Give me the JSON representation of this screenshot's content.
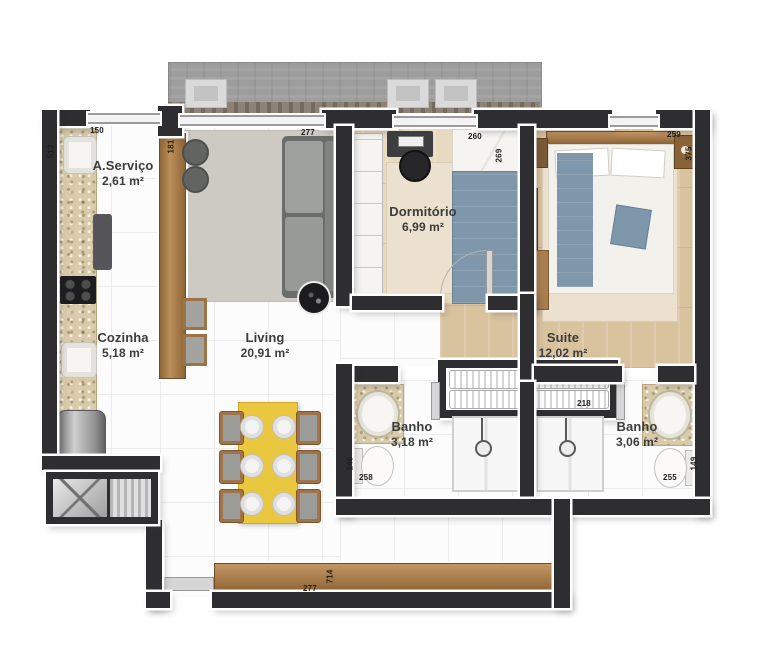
{
  "rooms": {
    "servico": {
      "name": "A.Serviço",
      "area": "2,61 m²"
    },
    "cozinha": {
      "name": "Cozinha",
      "area": "5,18 m²"
    },
    "living": {
      "name": "Living",
      "area": "20,91 m²"
    },
    "dormitorio": {
      "name": "Dormitório",
      "area": "6,99 m²"
    },
    "suite": {
      "name": "Suite",
      "area": "12,02 m²"
    },
    "banho_social": {
      "name": "Banho",
      "area": "3,18 m²"
    },
    "banho_suite": {
      "name": "Banho",
      "area": "3,06 m²"
    }
  },
  "dims": {
    "servico_width": "150",
    "servico_depth": "513",
    "panel_height": "181",
    "living_width": "277",
    "dorm_width": "260",
    "dorm_depth": "269",
    "suite_width": "259",
    "suite_depth": "375",
    "closet_width": "218",
    "banho_social_depth": "146",
    "banho_social_width": "258",
    "banho_suite_depth": "149",
    "banho_suite_width": "255",
    "living_length": "714",
    "living_bottom_width": "277"
  },
  "colors": {
    "wall": "#2e2e31",
    "wood": "#a97e4f",
    "granite": "#d9cbaa",
    "wood_floor": "#d9c29e",
    "table_yellow": "#e9c73e",
    "bed_blue": "#7e97ab",
    "concrete": "#9c9c9c",
    "rug_gray": "#cdcac3"
  }
}
